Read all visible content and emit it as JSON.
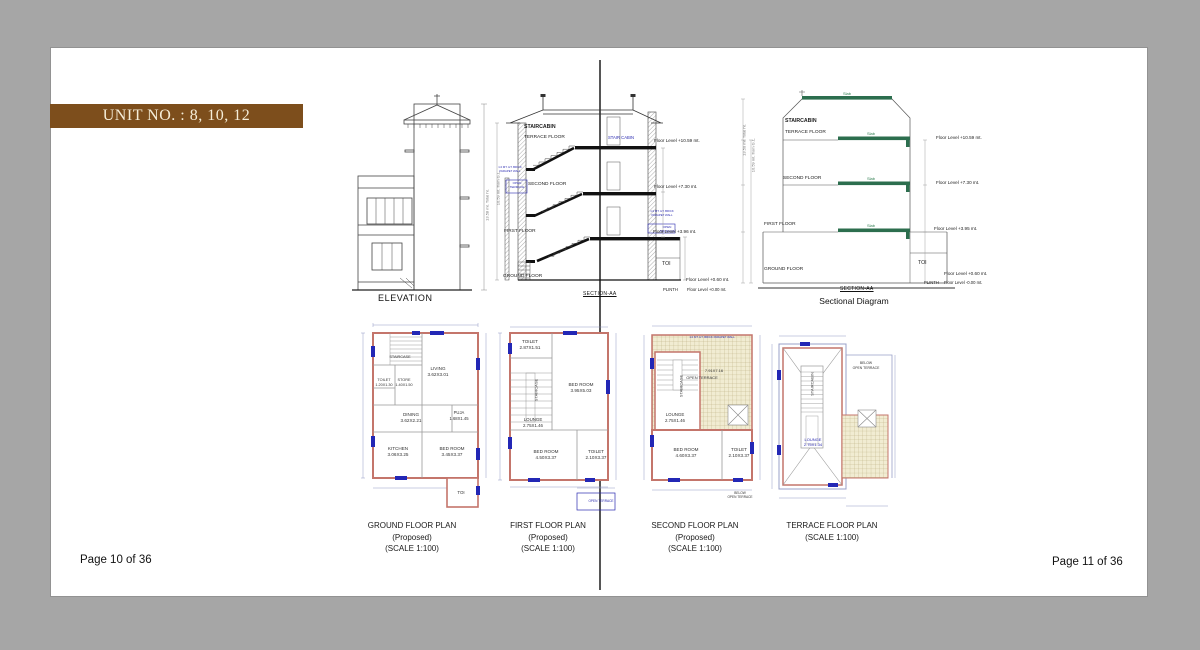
{
  "background": {
    "canvas": "#a6a6a6",
    "page": "#ffffff"
  },
  "banner": {
    "title": "UNIT NO. : 8, 10, 12",
    "bg": "#7d4e1c",
    "fg": "#f5edd8"
  },
  "footers": {
    "left": "Page 10 of 36",
    "right": "Page 11 of 36"
  },
  "elevation": {
    "caption": "ELEVATION",
    "dim_note": "13.58 mt. Total ht."
  },
  "section": {
    "caption": "SECTION-AA",
    "staircabin": "STAIRCABIN",
    "terrace_floor": "TERRACE FLOOR",
    "stair_cabin": "STAIR CABIN",
    "second_floor": "SECOND FLOOR",
    "first_floor": "FIRST FLOOR",
    "ground_floor": "GROUND FLOOR",
    "toi": "TOI",
    "open_terrace": "OPEN\nTERRACE",
    "parapet_note": "1.0 MT. HT. BRICK\nPARAPET WALL",
    "dim_note": "10.59 mt. from G.L.",
    "levels": {
      "terrace": "Floor Level +10.59 mt.",
      "second": "Floor Level +7.30 mt.",
      "first": "Floor Level +3.96 mt.",
      "plinth_top": "Floor Level +0.60 mt.",
      "plinth": "PLINTH",
      "ground": "Floor Level +0.00 mt."
    }
  },
  "sectional": {
    "caption": "Sectional Diagram",
    "section_label": "SECTION-AA",
    "slab": "Slab",
    "staircabin": "STAIRCABIN",
    "terrace_floor": "TERRACE FLOOR",
    "second_floor": "SECOND FLOOR",
    "first_floor": "FIRST FLOOR",
    "ground_floor": "GROUND FLOOR",
    "toi": "TOI",
    "dim_total": "13.50 mt. Total ht.",
    "dim_gl": "10.59 mt. from G.L.",
    "levels": {
      "terrace": "Floor Level +10.59 mt.",
      "second": "Floor Level +7.30 mt.",
      "first": "Floor Level +3.95 mt.",
      "plinth_top": "Floor Level +0.60 mt.",
      "plinth": "PLINTH",
      "ground": "Floor Level -0.00 mt."
    }
  },
  "plans": {
    "ground": {
      "caption": "GROUND FLOOR PLAN\n(Proposed)\n(SCALE 1:100)",
      "staircase": "STAIRCASE",
      "rooms": {
        "living": {
          "name": "LIVING",
          "dims": "3.62X3.01"
        },
        "toilet": {
          "name": "TOILET",
          "dims": "1.20X1.30"
        },
        "store": {
          "name": "STORE",
          "dims": "1.40X1.50"
        },
        "dining": {
          "name": "DINING",
          "dims": "3.62X2.21"
        },
        "puja": {
          "name": "PUJA",
          "dims": "1.68X1.45"
        },
        "kitchen": {
          "name": "KITCHEN",
          "dims": "3.06X3.25"
        },
        "bedroom": {
          "name": "BED ROOM",
          "dims": "3.45X3.37"
        },
        "toi": {
          "name": "TOI"
        }
      }
    },
    "first": {
      "caption": "FIRST FLOOR PLAN\n(Proposed)\n(SCALE 1:100)",
      "staircase": "STAIRCASE",
      "open_terrace": "OPEN TERRACE",
      "rooms": {
        "toilet_top": {
          "name": "TOILET",
          "dims": "2.87X1.51"
        },
        "bedroom_right": {
          "name": "BED ROOM",
          "dims": "3.95X5.03"
        },
        "lounge": {
          "name": "LOUNGE",
          "dims": "2.75X1.46"
        },
        "bedroom_bottom": {
          "name": "BED ROOM",
          "dims": "4.50X3.37"
        },
        "toilet_bottom": {
          "name": "TOILET",
          "dims": "2.10X3.37"
        }
      }
    },
    "second": {
      "caption": "SECOND FLOOR PLAN\n(Proposed)\n(SCALE 1:100)",
      "staircase": "STAIRCASE",
      "parapet_note": "1.0 MT. HT. BRICK PARAPET WALL",
      "below_open_terrace": "BELOW\nOPEN TERRACE",
      "rooms": {
        "open_terrace": {
          "name": "OPEN TERRACE",
          "dims": "7.91X7.16"
        },
        "lounge": {
          "name": "LOUNGE",
          "dims": "2.75X1.46"
        },
        "bedroom": {
          "name": "BED ROOM",
          "dims": "4.60X3.37"
        },
        "toilet": {
          "name": "TOILET",
          "dims": "2.10X3.37"
        }
      }
    },
    "terrace": {
      "caption": "TERRACE FLOOR PLAN\n(SCALE 1:100)",
      "staircabin": "STAIRCABIN",
      "below_open_terrace": "BELOW\nOPEN TERRACE",
      "rooms": {
        "lounge": {
          "name": "LOUNGE",
          "dims": "2.75X1.34"
        }
      }
    }
  }
}
